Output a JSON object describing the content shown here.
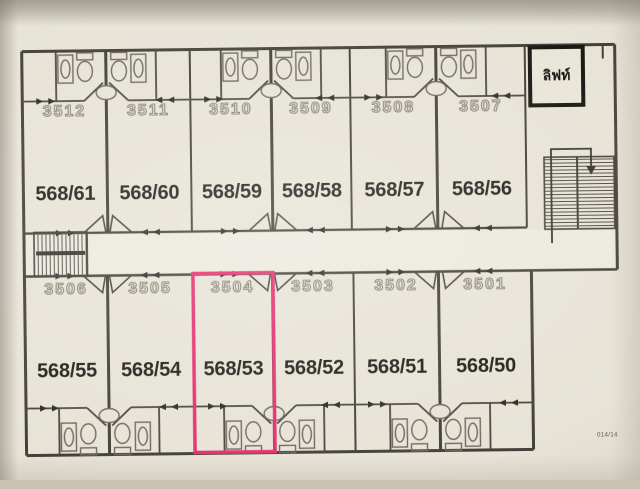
{
  "plan": {
    "elevator_label": "ลิฟท์",
    "corner_note": "014/14",
    "highlighted_room": "3504",
    "highlight_color": "#e5306d",
    "wall_color": "#44403a",
    "top_row": {
      "rooms": [
        {
          "room_no": "3512",
          "unit_no": "568/61"
        },
        {
          "room_no": "3511",
          "unit_no": "568/60"
        },
        {
          "room_no": "3510",
          "unit_no": "568/59"
        },
        {
          "room_no": "3509",
          "unit_no": "568/58"
        },
        {
          "room_no": "3508",
          "unit_no": "568/57"
        },
        {
          "room_no": "3507",
          "unit_no": "568/56"
        }
      ]
    },
    "bottom_row": {
      "rooms": [
        {
          "room_no": "3506",
          "unit_no": "568/55"
        },
        {
          "room_no": "3505",
          "unit_no": "568/54"
        },
        {
          "room_no": "3504",
          "unit_no": "568/53",
          "highlighted": true
        },
        {
          "room_no": "3503",
          "unit_no": "568/52"
        },
        {
          "room_no": "3502",
          "unit_no": "568/51"
        },
        {
          "room_no": "3501",
          "unit_no": "568/50"
        }
      ]
    }
  }
}
